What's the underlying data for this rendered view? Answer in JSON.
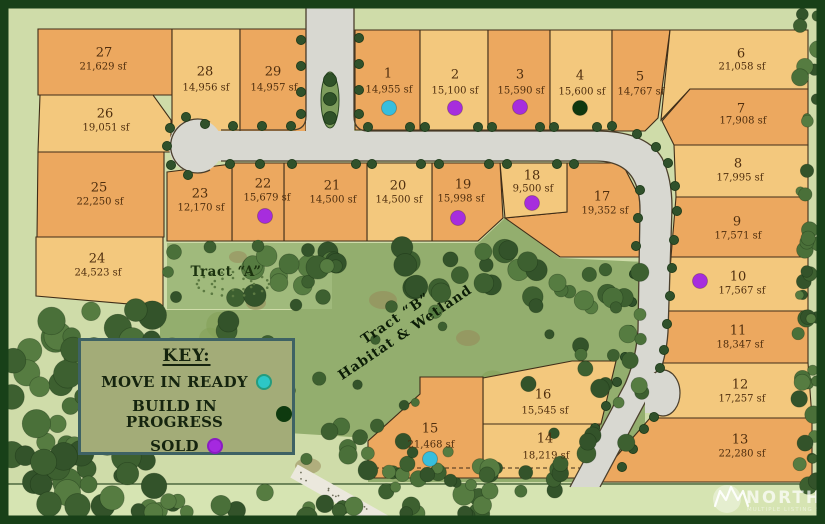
{
  "legend": {
    "title": "KEY:",
    "items": [
      {
        "label": "MOVE IN READY",
        "status": "move-in-ready",
        "color": "#2dc7c6",
        "ring": "#259b7e"
      },
      {
        "label": "BUILD IN PROGRESS",
        "status": "build-in-progress",
        "color": "#0e3a0f",
        "ring": "#0e3a0f"
      },
      {
        "label": "SOLD",
        "status": "sold",
        "color": "#a529e0",
        "ring": "#8a1cc2"
      }
    ]
  },
  "tracts": [
    {
      "name": "Tract “A”",
      "x": 226,
      "y": 272,
      "rotation": 0
    },
    {
      "name": "Tract “B”",
      "line2": "Habitat & Wetland",
      "x": 398,
      "y": 322,
      "rotation": -34
    }
  ],
  "watermark": {
    "brand": "NORTHWEST",
    "tagline": "MULTIPLE LISTING SERVICE"
  },
  "colors": {
    "bg": "#cfdca9",
    "strip": "#d6e4b2",
    "forest": "#93ae6e",
    "tract_a": "#a0ba7c",
    "road": "#d8d8d1",
    "road_edge": "#4b3f2c",
    "outline": "#3f2d18",
    "text": "#4f2e0e",
    "lot_dark": "#eca85f",
    "lot_light": "#f3c87d",
    "frame": "#184018",
    "status": {
      "move-in-ready": "#37bedd",
      "build-in-progress": "#10380f",
      "sold": "#a72ddd"
    }
  },
  "lots": [
    {
      "id": "27",
      "sqft": "21,629 sf",
      "shade": "dark",
      "poly": [
        [
          38,
          29
        ],
        [
          172,
          29
        ],
        [
          172,
          95
        ],
        [
          38,
          95
        ]
      ],
      "num": [
        104,
        53
      ],
      "sq": [
        103,
        67
      ],
      "dot": null
    },
    {
      "id": "26",
      "sqft": "19,051 sf",
      "shade": "light",
      "poly": [
        [
          40,
          95
        ],
        [
          153,
          95
        ],
        [
          171,
          120
        ],
        [
          171,
          152
        ],
        [
          38,
          152
        ]
      ],
      "num": [
        105,
        114
      ],
      "sq": [
        106,
        128
      ],
      "dot": null
    },
    {
      "id": "25",
      "sqft": "22,250 sf",
      "shade": "dark",
      "poly": [
        [
          38,
          152
        ],
        [
          164,
          152
        ],
        [
          164,
          237
        ],
        [
          37,
          237
        ]
      ],
      "num": [
        99,
        188
      ],
      "sq": [
        100,
        202
      ],
      "dot": null
    },
    {
      "id": "24",
      "sqft": "24,523 sf",
      "shade": "light",
      "poly": [
        [
          36,
          237
        ],
        [
          163,
          237
        ],
        [
          163,
          307
        ],
        [
          36,
          296
        ]
      ],
      "num": [
        97,
        259
      ],
      "sq": [
        98,
        273
      ],
      "dot": null
    },
    {
      "id": "28",
      "sqft": "14,956 sf",
      "shade": "light",
      "poly": [
        [
          172,
          29
        ],
        [
          240,
          29
        ],
        [
          240,
          132
        ],
        [
          172,
          132
        ]
      ],
      "num": [
        205,
        72
      ],
      "sq": [
        206,
        88
      ],
      "dot": null
    },
    {
      "id": "29",
      "sqft": "14,957 sf",
      "shade": "dark",
      "poly": [
        [
          240,
          29
        ],
        [
          306,
          29
        ],
        [
          306,
          132
        ],
        [
          240,
          132
        ]
      ],
      "num": [
        273,
        72
      ],
      "sq": [
        274,
        88
      ],
      "dot": null
    },
    {
      "id": "1",
      "sqft": "14,955 sf",
      "shade": "dark",
      "poly": [
        [
          355,
          30
        ],
        [
          420,
          30
        ],
        [
          420,
          130
        ],
        [
          355,
          130
        ]
      ],
      "num": [
        388,
        74
      ],
      "sq": [
        389,
        90
      ],
      "dot": {
        "status": "move-in-ready",
        "x": 389,
        "y": 108
      }
    },
    {
      "id": "2",
      "sqft": "15,100 sf",
      "shade": "light",
      "poly": [
        [
          420,
          30
        ],
        [
          488,
          30
        ],
        [
          488,
          130
        ],
        [
          420,
          130
        ]
      ],
      "num": [
        455,
        75
      ],
      "sq": [
        455,
        91
      ],
      "dot": {
        "status": "sold",
        "x": 455,
        "y": 108
      }
    },
    {
      "id": "3",
      "sqft": "15,590 sf",
      "shade": "dark",
      "poly": [
        [
          488,
          30
        ],
        [
          550,
          30
        ],
        [
          550,
          130
        ],
        [
          488,
          130
        ]
      ],
      "num": [
        520,
        75
      ],
      "sq": [
        521,
        91
      ],
      "dot": {
        "status": "sold",
        "x": 520,
        "y": 107
      }
    },
    {
      "id": "4",
      "sqft": "15,600 sf",
      "shade": "light",
      "poly": [
        [
          550,
          30
        ],
        [
          612,
          30
        ],
        [
          612,
          130
        ],
        [
          550,
          130
        ]
      ],
      "num": [
        580,
        76
      ],
      "sq": [
        582,
        92
      ],
      "dot": {
        "status": "build-in-progress",
        "x": 580,
        "y": 108
      }
    },
    {
      "id": "5",
      "sqft": "14,767 sf",
      "shade": "dark",
      "poly": [
        [
          612,
          30
        ],
        [
          670,
          30
        ],
        [
          658,
          118
        ],
        [
          645,
          131
        ],
        [
          612,
          131
        ]
      ],
      "num": [
        640,
        77
      ],
      "sq": [
        641,
        92
      ],
      "dot": null
    },
    {
      "id": "6",
      "sqft": "21,058 sf",
      "shade": "light",
      "poly": [
        [
          670,
          30
        ],
        [
          808,
          30
        ],
        [
          808,
          89
        ],
        [
          690,
          89
        ],
        [
          661,
          120
        ]
      ],
      "num": [
        741,
        54
      ],
      "sq": [
        742,
        67
      ],
      "dot": null
    },
    {
      "id": "7",
      "sqft": "17,908 sf",
      "shade": "dark",
      "poly": [
        [
          690,
          89
        ],
        [
          808,
          89
        ],
        [
          808,
          145
        ],
        [
          674,
          145
        ],
        [
          662,
          121
        ]
      ],
      "num": [
        741,
        109
      ],
      "sq": [
        743,
        121
      ],
      "dot": null
    },
    {
      "id": "8",
      "sqft": "17,995 sf",
      "shade": "light",
      "poly": [
        [
          674,
          145
        ],
        [
          808,
          145
        ],
        [
          808,
          197
        ],
        [
          676,
          197
        ]
      ],
      "num": [
        738,
        164
      ],
      "sq": [
        740,
        178
      ],
      "dot": null
    },
    {
      "id": "9",
      "sqft": "17,571 sf",
      "shade": "dark",
      "poly": [
        [
          676,
          197
        ],
        [
          808,
          197
        ],
        [
          808,
          257
        ],
        [
          671,
          257
        ]
      ],
      "num": [
        737,
        222
      ],
      "sq": [
        738,
        236
      ],
      "dot": null
    },
    {
      "id": "10",
      "sqft": "17,567 sf",
      "shade": "light",
      "poly": [
        [
          671,
          257
        ],
        [
          808,
          257
        ],
        [
          808,
          311
        ],
        [
          667,
          311
        ]
      ],
      "num": [
        738,
        277
      ],
      "sq": [
        742,
        291
      ],
      "dot": {
        "status": "sold",
        "x": 700,
        "y": 281
      }
    },
    {
      "id": "11",
      "sqft": "18,347 sf",
      "shade": "dark",
      "poly": [
        [
          667,
          311
        ],
        [
          808,
          311
        ],
        [
          808,
          363
        ],
        [
          663,
          363
        ]
      ],
      "num": [
        738,
        331
      ],
      "sq": [
        740,
        345
      ],
      "dot": null
    },
    {
      "id": "12",
      "sqft": "17,257 sf",
      "shade": "light",
      "poly": [
        [
          663,
          363
        ],
        [
          808,
          363
        ],
        [
          812,
          418
        ],
        [
          650,
          418
        ]
      ],
      "num": [
        740,
        385
      ],
      "sq": [
        742,
        399
      ],
      "dot": null
    },
    {
      "id": "13",
      "sqft": "22,280 sf",
      "shade": "dark",
      "poly": [
        [
          650,
          418
        ],
        [
          812,
          418
        ],
        [
          812,
          482
        ],
        [
          594,
          482
        ]
      ],
      "num": [
        740,
        440
      ],
      "sq": [
        742,
        454
      ],
      "dot": null
    },
    {
      "id": "17",
      "sqft": "19,352 sf",
      "shade": "dark",
      "poly": [
        [
          567,
          163
        ],
        [
          622,
          163
        ],
        [
          641,
          200
        ],
        [
          645,
          257
        ],
        [
          560,
          257
        ],
        [
          505,
          218
        ],
        [
          567,
          212
        ]
      ],
      "num": [
        602,
        197
      ],
      "sq": [
        605,
        211
      ],
      "dot": null
    },
    {
      "id": "18",
      "sqft": "9,500 sf",
      "shade": "light",
      "poly": [
        [
          500,
          163
        ],
        [
          567,
          163
        ],
        [
          567,
          212
        ],
        [
          505,
          218
        ]
      ],
      "num": [
        532,
        176
      ],
      "sq": [
        533,
        189
      ],
      "dot": {
        "status": "sold",
        "x": 532,
        "y": 203
      }
    },
    {
      "id": "19",
      "sqft": "15,998 sf",
      "shade": "dark",
      "poly": [
        [
          432,
          163
        ],
        [
          500,
          163
        ],
        [
          503,
          218
        ],
        [
          478,
          241
        ],
        [
          432,
          241
        ]
      ],
      "num": [
        463,
        185
      ],
      "sq": [
        461,
        199
      ],
      "dot": {
        "status": "sold",
        "x": 458,
        "y": 218
      }
    },
    {
      "id": "20",
      "sqft": "14,500 sf",
      "shade": "light",
      "poly": [
        [
          367,
          163
        ],
        [
          432,
          163
        ],
        [
          432,
          241
        ],
        [
          367,
          241
        ]
      ],
      "num": [
        398,
        186
      ],
      "sq": [
        399,
        200
      ],
      "dot": null
    },
    {
      "id": "21",
      "sqft": "14,500 sf",
      "shade": "dark",
      "poly": [
        [
          284,
          163
        ],
        [
          367,
          163
        ],
        [
          367,
          241
        ],
        [
          284,
          241
        ]
      ],
      "num": [
        332,
        186
      ],
      "sq": [
        333,
        200
      ],
      "dot": null
    },
    {
      "id": "22",
      "sqft": "15,679 sf",
      "shade": "dark",
      "poly": [
        [
          232,
          163
        ],
        [
          284,
          163
        ],
        [
          284,
          241
        ],
        [
          232,
          241
        ]
      ],
      "num": [
        263,
        184
      ],
      "sq": [
        267,
        198
      ],
      "dot": {
        "status": "sold",
        "x": 265,
        "y": 216
      }
    },
    {
      "id": "23",
      "sqft": "12,170 sf",
      "shade": "dark",
      "poly": [
        [
          167,
          172
        ],
        [
          232,
          164
        ],
        [
          232,
          241
        ],
        [
          167,
          241
        ]
      ],
      "num": [
        200,
        194
      ],
      "sq": [
        201,
        208
      ],
      "dot": null
    },
    {
      "id": "16",
      "sqft": "15,545 sf",
      "shade": "light",
      "poly": [
        [
          483,
          378
        ],
        [
          572,
          361
        ],
        [
          616,
          361
        ],
        [
          601,
          424
        ],
        [
          483,
          424
        ]
      ],
      "num": [
        543,
        395
      ],
      "sq": [
        545,
        411
      ],
      "dot": null
    },
    {
      "id": "14",
      "sqft": "18,219 sf",
      "shade": "light",
      "poly": [
        [
          483,
          424
        ],
        [
          600,
          424
        ],
        [
          586,
          478
        ],
        [
          483,
          478
        ]
      ],
      "num": [
        545,
        439
      ],
      "sq": [
        546,
        456
      ],
      "dot": null
    },
    {
      "id": "15",
      "sqft": "21,468 sf",
      "shade": "dark",
      "poly": [
        [
          420,
          377
        ],
        [
          483,
          377
        ],
        [
          483,
          478
        ],
        [
          368,
          478
        ],
        [
          368,
          441
        ],
        [
          420,
          394
        ]
      ],
      "num": [
        430,
        429
      ],
      "sq": [
        431,
        445
      ],
      "dot": {
        "status": "move-in-ready",
        "x": 430,
        "y": 459
      }
    }
  ]
}
